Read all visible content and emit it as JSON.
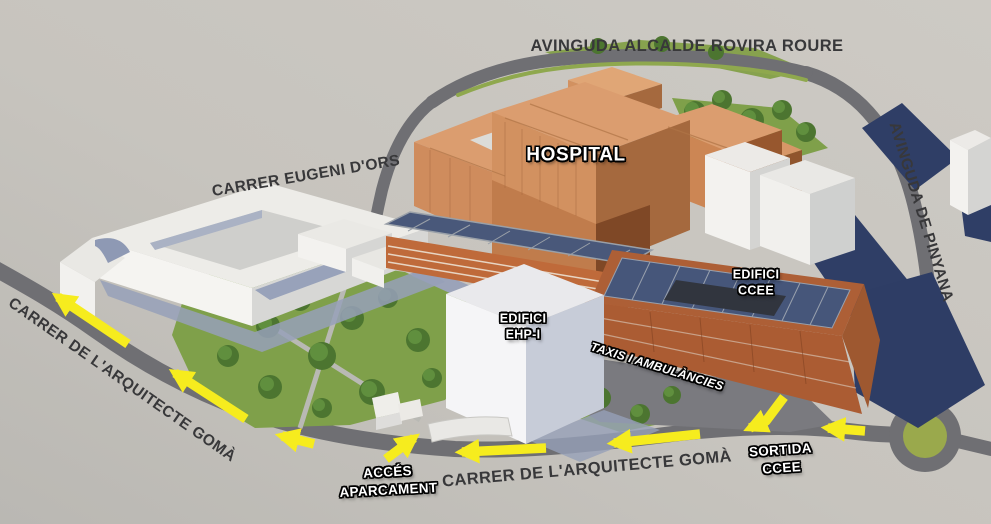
{
  "map": {
    "street_labels": {
      "avinguda_alcalde_rovira_roure": "AVINGUDA ALCALDE ROVIRA ROURE",
      "carrer_eugeni_dors": "CARRER EUGENI D'ORS",
      "avinguda_de_pinyana": "AVINGUDA DE PINYANA",
      "carrer_arquitecte_goma_left": "CARRER DE L'ARQUITECTE GOMÀ",
      "carrer_arquitecte_goma_bottom": "CARRER DE L'ARQUITECTE GOMÀ"
    },
    "building_labels": {
      "hospital": "HOSPITAL",
      "edifici_ccee": {
        "line1": "EDIFICI",
        "line2": "CCEE"
      },
      "edifici_ehp": {
        "line1": "EDIFICI",
        "line2": "EHP-I"
      }
    },
    "route_labels": {
      "taxis_ambulancies": "TAXIS I AMBULÀNCIES",
      "acces_aparcament": {
        "line1": "ACCÉS",
        "line2": "APARCAMENT"
      },
      "sortida_ccee": {
        "line1": "SORTIDA",
        "line2": "CCEE"
      }
    },
    "colors": {
      "background": "#c9c6c0",
      "road": "#6f6f73",
      "park_green": "#7fa04a",
      "hospital_facade": "#d29160",
      "solar_panel_navy": "#46567a",
      "shadow_navy": "#2e3d65",
      "arrow_yellow": "#f6ec1e"
    }
  }
}
